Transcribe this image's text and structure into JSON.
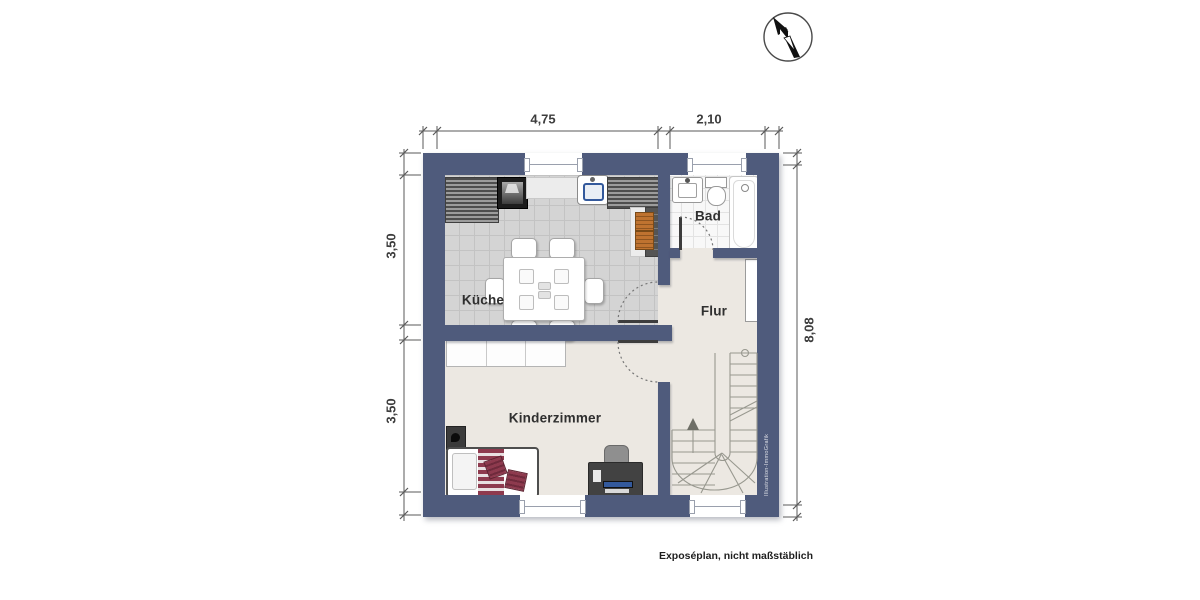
{
  "page": {
    "footer_note": "Exposéplan, nicht maßstäblich",
    "watermark": "Illustration-ImmoGrafik"
  },
  "rooms": {
    "kueche": "Küche",
    "bad": "Bad",
    "flur": "Flur",
    "kinderzimmer": "Kinderzimmer"
  },
  "dimensions": {
    "top_left": "4,75",
    "top_right": "2,10",
    "left_upper": "3,50",
    "left_lower": "3,50",
    "right": "8,08"
  },
  "colors": {
    "wall": "#4f5b7c",
    "floor": "#ece8e2",
    "kitchen_tile": "#d4d4d4",
    "bath_tile": "#f8f8f8",
    "accent_red": "#8e3a4e",
    "accent_orange": "#bf7330",
    "accent_blue": "#33599c",
    "stair_line": "#98988f",
    "dim_line": "#5a5a5a",
    "text": "#3d3d3d"
  }
}
